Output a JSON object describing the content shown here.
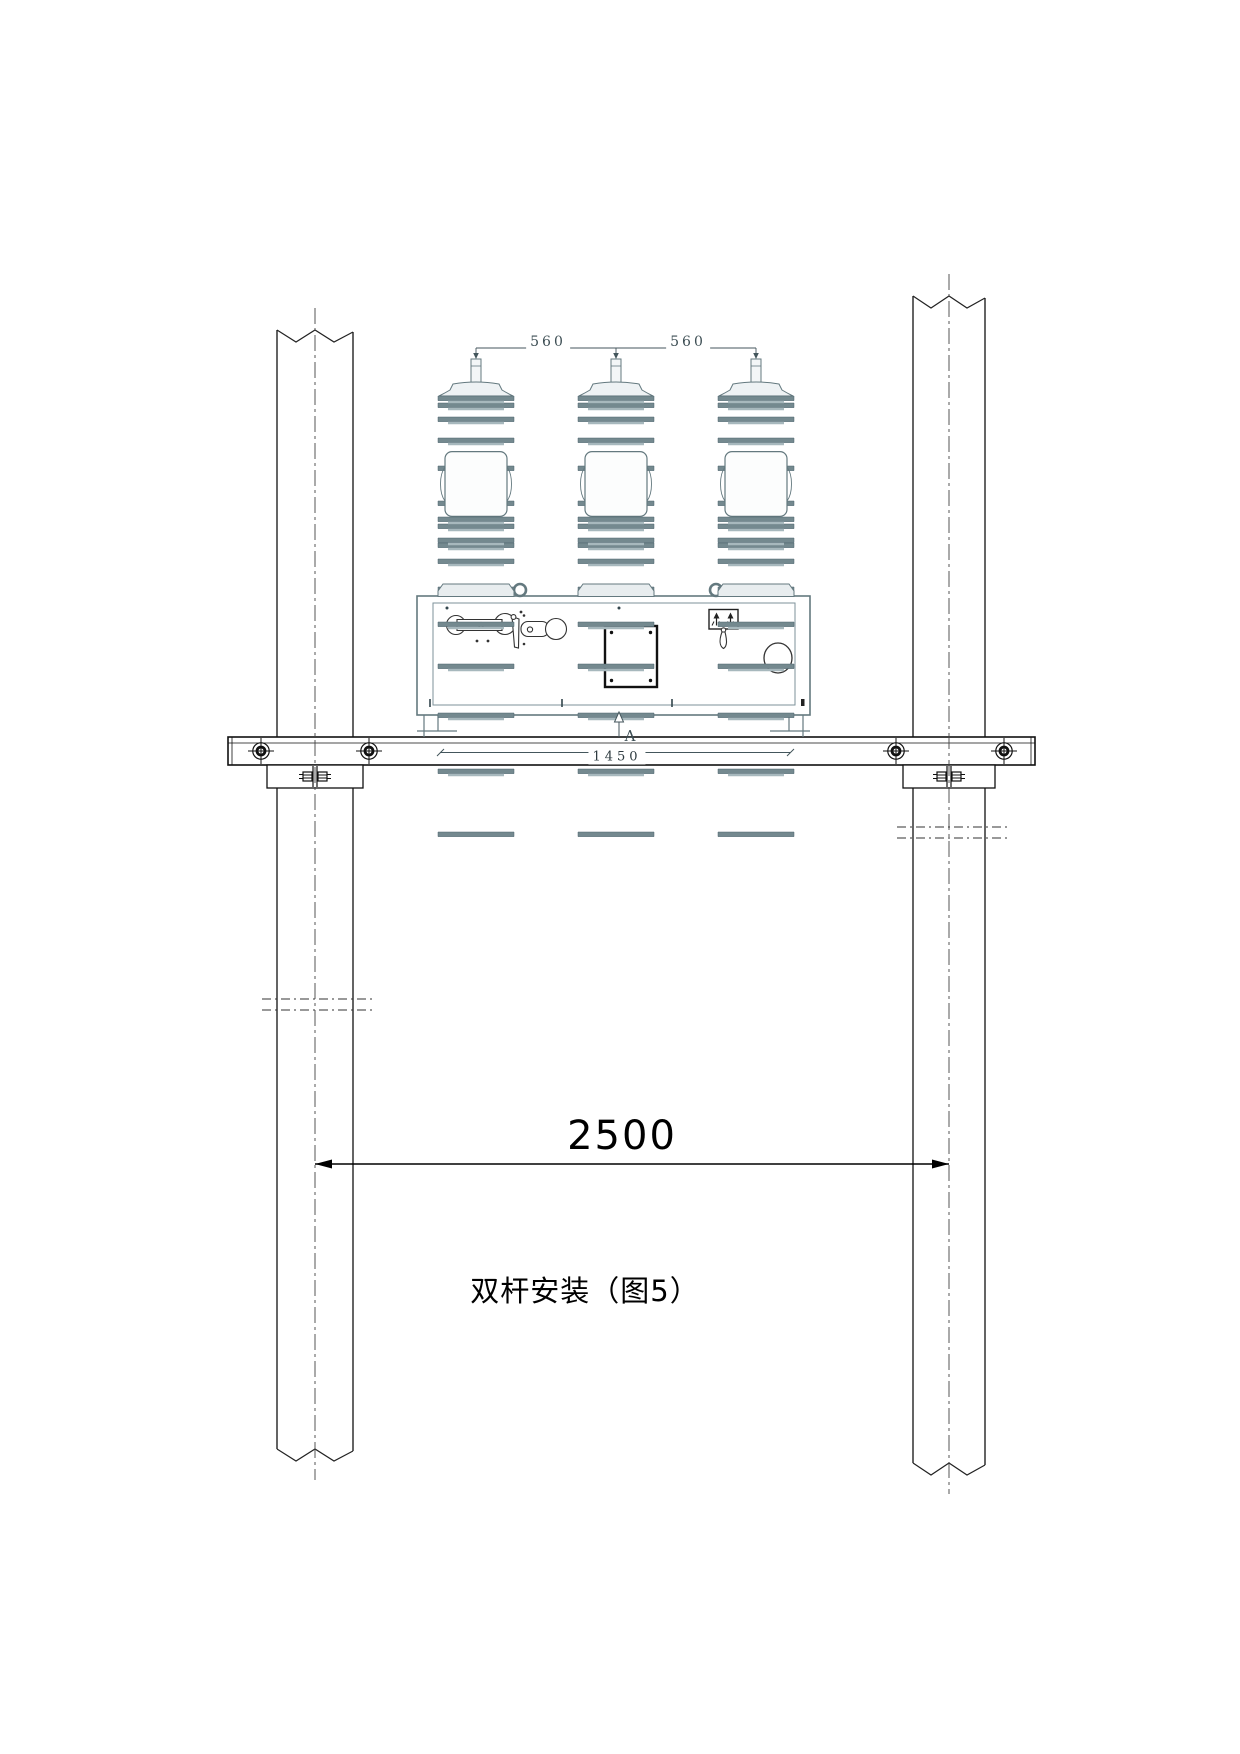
{
  "drawing": {
    "caption": "双杆安装（图5）",
    "section_marker": "A",
    "dimensions": {
      "phase_spacing_left": "560",
      "phase_spacing_right": "560",
      "mounting_hole_span": "1450",
      "pole_spacing": "2500"
    },
    "colors": {
      "paper": "#ffffff",
      "equipment_line": "#64797f",
      "fin_dark": "#74898f",
      "fin_light": "#a7b8bd",
      "ink": "#1a1a1a",
      "dim_gray": "#44565c"
    }
  }
}
